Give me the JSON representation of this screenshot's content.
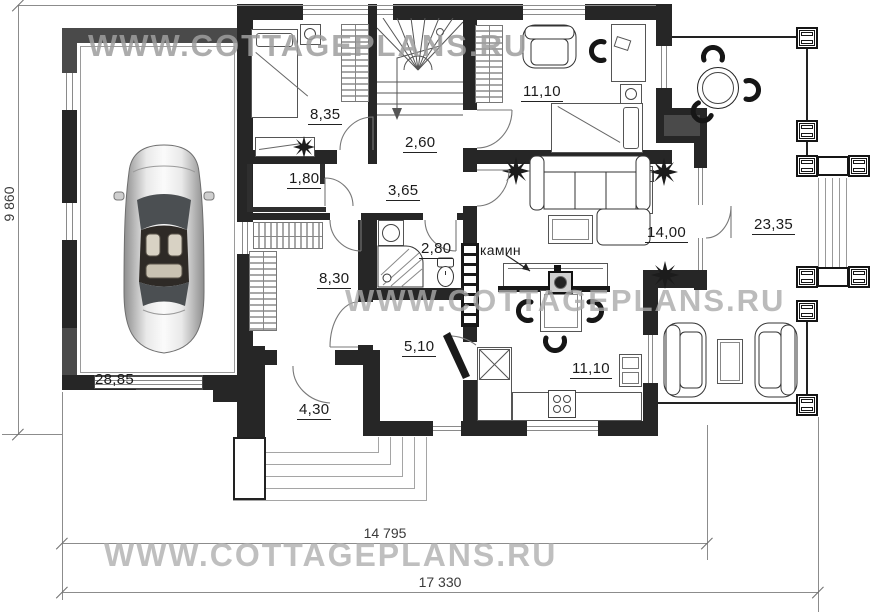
{
  "watermark": {
    "text": "WWW.COTTAGEPLANS.RU"
  },
  "dimensions": {
    "vertical_total": "9 860",
    "horizontal_inner": "14 795",
    "horizontal_total": "17 330"
  },
  "rooms": {
    "bedroom1": "8,35",
    "stair_hall": "2,60",
    "closet": "1,80",
    "corridor": "3,65",
    "bedroom2": "11,10",
    "living_room": "14,00",
    "terrace": "23,35",
    "bathroom": "2,80",
    "storage": "8,30",
    "hallway": "5,10",
    "garage": "28,85",
    "porch": "4,30",
    "kitchen": "11,10"
  },
  "annotations": {
    "fireplace": "камин"
  },
  "colors": {
    "wall": "#262626",
    "garage_wall": "#4a4a4a",
    "dim_line": "#8c8c8c",
    "watermark": "#a0a0a0",
    "label_text": "#1b1b1b"
  }
}
